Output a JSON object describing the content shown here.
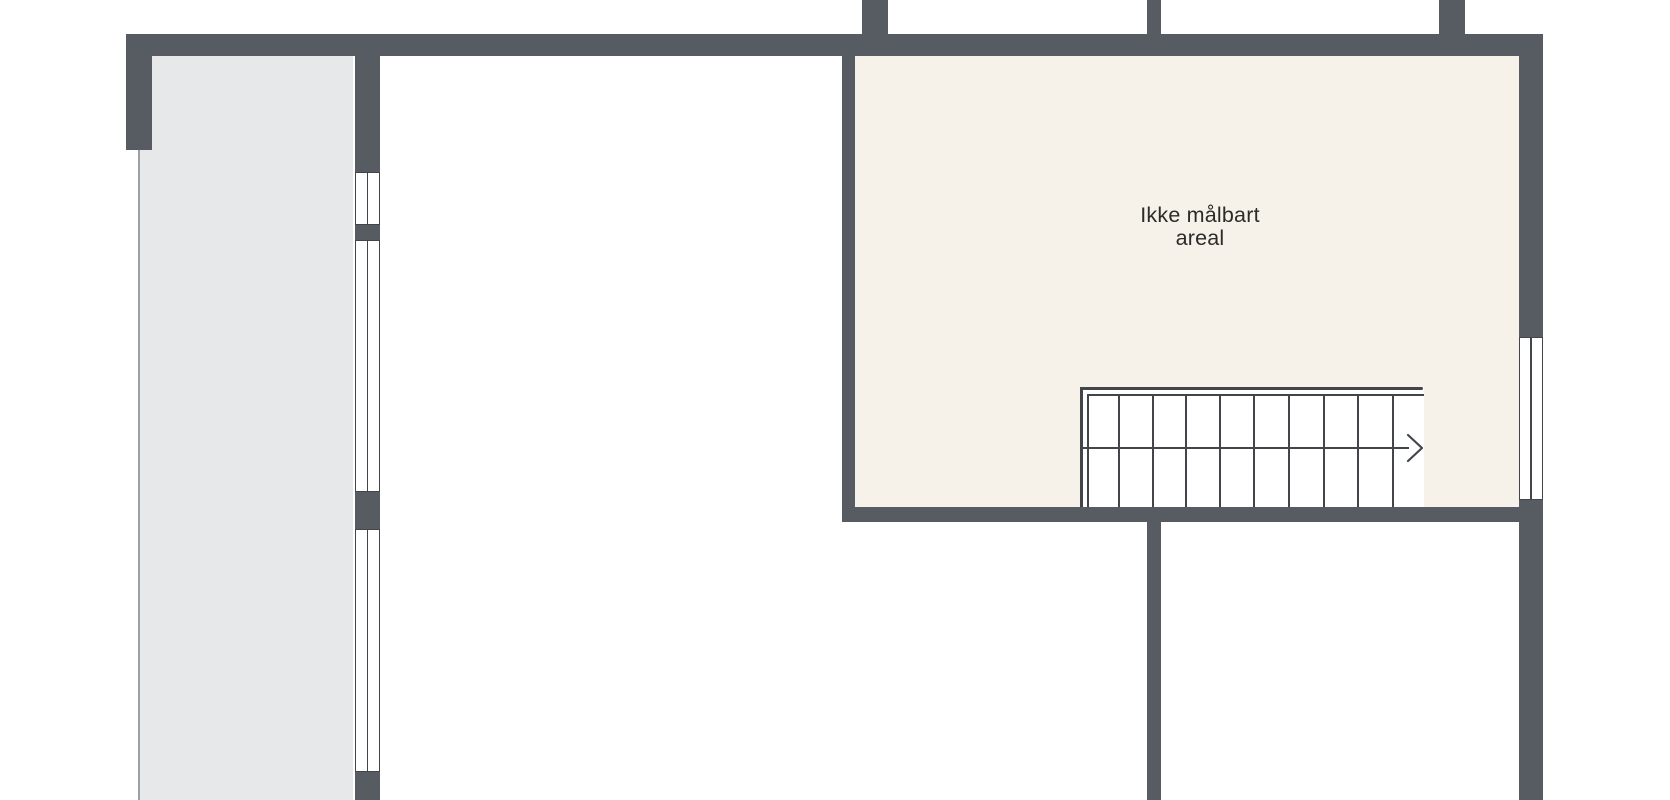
{
  "floor_plan": {
    "labels": {
      "unmeasurable_area": "Ikke målbart\nareal"
    },
    "staircase": {
      "tread_count": 9,
      "direction": "right"
    },
    "colors": {
      "wall": "#575c63",
      "unmeasurable_area_fill": "#f6f2e9",
      "open_area_fill": "#e7e8e9",
      "background": "#ffffff",
      "line": "#42454a",
      "boundary_line": "#9ba0a4",
      "label_text": "#2b2b29"
    }
  }
}
